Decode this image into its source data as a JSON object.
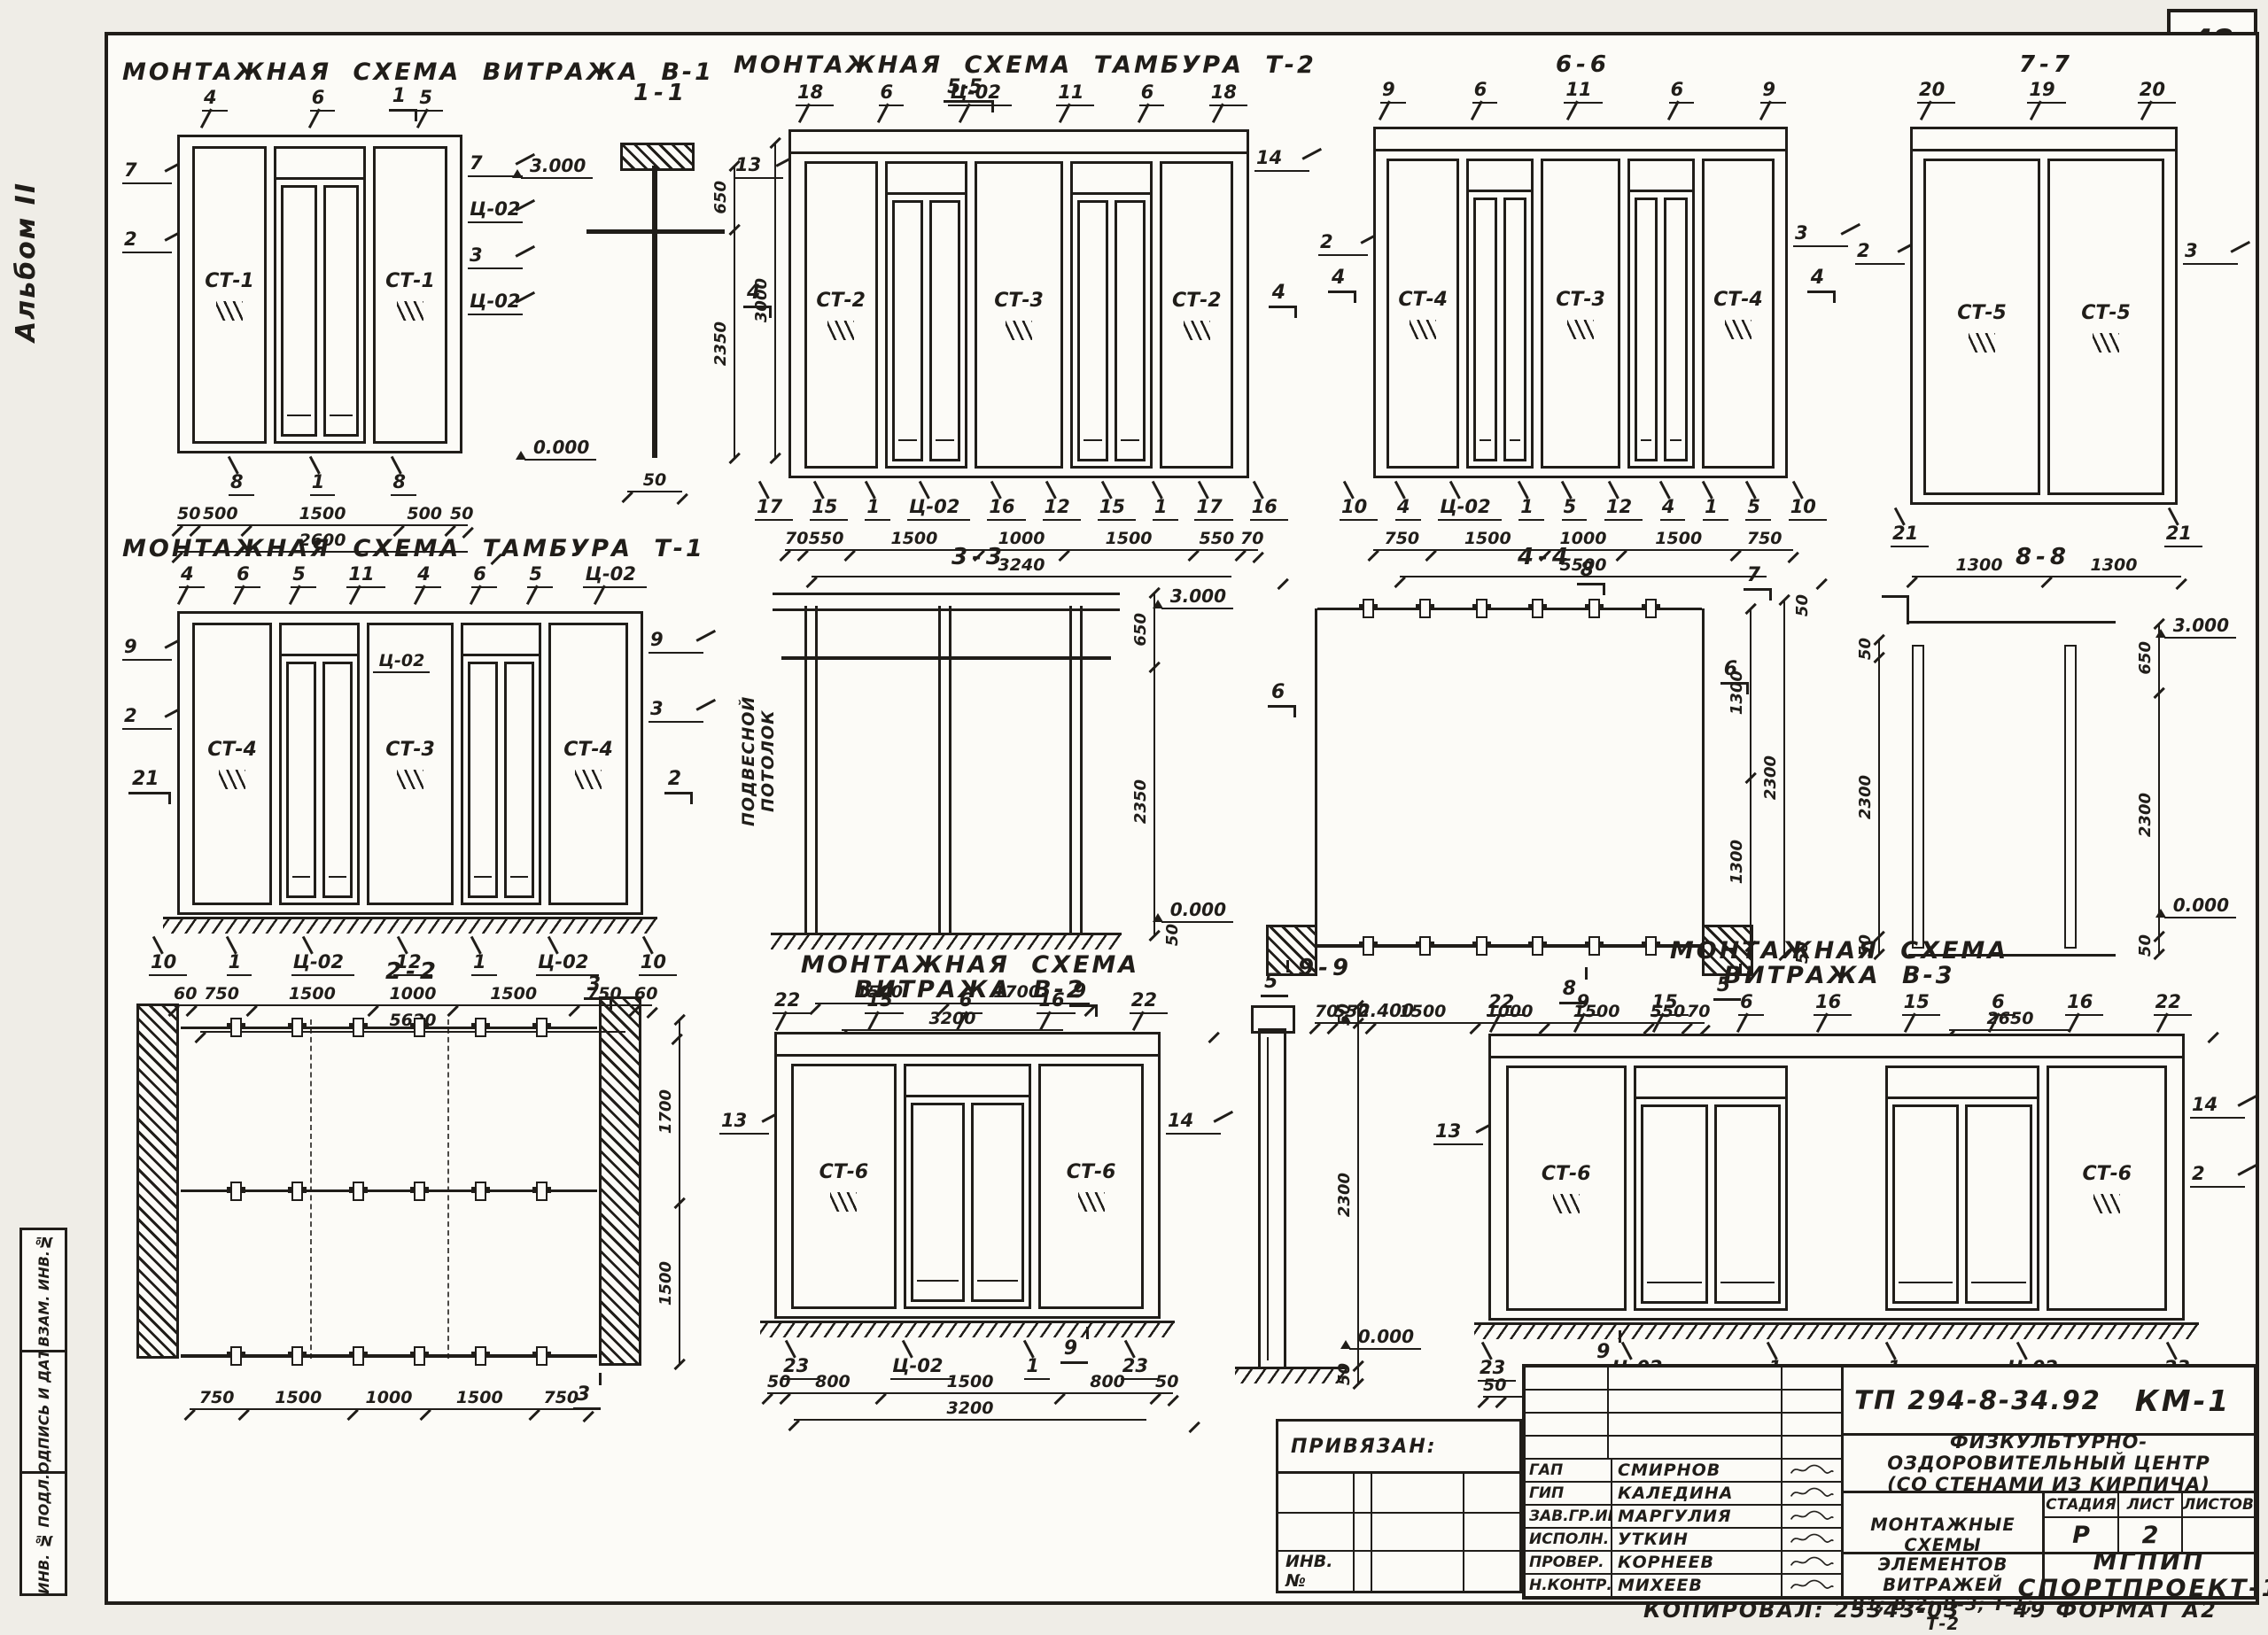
{
  "page": {
    "album_label": "Альбом II",
    "page_number": "48",
    "edge_strip": [
      "ВЗАМ. ИНВ.№",
      "ПОДПИСЬ И ДАТА",
      "ИНВ. № ПОДЛ."
    ]
  },
  "drawings": {
    "v1": {
      "title": "МОНТАЖНАЯ СХЕМА ВИТРАЖА В-1",
      "smark_top": "1",
      "smark_bottom": "1",
      "callouts_top": [
        "4",
        "6",
        "5"
      ],
      "callouts_left": [
        "7",
        "2"
      ],
      "callouts_right": [
        "7",
        "Ц-02",
        "3",
        "Ц-02"
      ],
      "callouts_bottom": [
        "8",
        "1",
        "8"
      ],
      "panels": [
        "СТ-1",
        "СТ-1"
      ],
      "dims": [
        "50",
        "500",
        "1500",
        "500",
        "50"
      ],
      "total": "2600"
    },
    "s11": {
      "title": "1-1",
      "level_top": "3.000",
      "level_bottom": "0.000",
      "dims_right": [
        "650",
        "2350"
      ],
      "dim_total_right": "3000",
      "dim_bottom": "50"
    },
    "t2": {
      "title": "МОНТАЖНАЯ СХЕМА ТАМБУРА Т-2",
      "smark_flag": "5-5",
      "callouts_top": [
        "18",
        "6",
        "Ц-02",
        "11",
        "6",
        "18"
      ],
      "callouts_left": [
        "13"
      ],
      "smark_left": "4",
      "callouts_right": [
        "14"
      ],
      "smark_right": "4",
      "callouts_bottom": [
        "17",
        "15",
        "1",
        "Ц-02",
        "16",
        "12",
        "15",
        "1",
        "17",
        "16"
      ],
      "panels": [
        "СТ-2",
        "СТ-3",
        "СТ-2"
      ],
      "dims": [
        "70",
        "550",
        "1500",
        "1000",
        "1500",
        "550",
        "70"
      ],
      "total": "3240"
    },
    "s66": {
      "title": "6-6",
      "callouts_top": [
        "9",
        "6",
        "11",
        "6",
        "9"
      ],
      "callouts_left": [
        "2"
      ],
      "smark_left": "4",
      "callouts_right": [
        "3"
      ],
      "smark_right": "4",
      "callouts_bottom": [
        "10",
        "4",
        "Ц-02",
        "1",
        "5",
        "12",
        "4",
        "1",
        "5",
        "10"
      ],
      "panels": [
        "СТ-4",
        "СТ-3",
        "СТ-4"
      ],
      "dims": [
        "750",
        "1500",
        "1000",
        "1500",
        "750"
      ],
      "total": "5500"
    },
    "s77": {
      "title": "7-7",
      "callouts_top": [
        "20",
        "19",
        "20"
      ],
      "callouts_left": [
        "2"
      ],
      "callouts_right": [
        "3"
      ],
      "callouts_bottom": [
        "21",
        "21"
      ],
      "panels": [
        "СТ-5",
        "СТ-5"
      ],
      "dims": [
        "1300",
        "1300"
      ]
    },
    "t1": {
      "title": "МОНТАЖНАЯ СХЕМА ТАМБУРА Т-1",
      "callouts_top": [
        "4",
        "6",
        "5",
        "11",
        "4",
        "6",
        "5",
        "Ц-02"
      ],
      "callouts_left": [
        "9",
        "2"
      ],
      "smark_left": "21",
      "callouts_right": [
        "9",
        "3"
      ],
      "smark_right": "2",
      "inner_label": "Ц-02",
      "callouts_bottom": [
        "10",
        "1",
        "Ц-02",
        "12",
        "1",
        "Ц-02",
        "10"
      ],
      "panels": [
        "СТ-4",
        "СТ-3",
        "СТ-4"
      ],
      "dims": [
        "60",
        "750",
        "1500",
        "1000",
        "1500",
        "750",
        "60"
      ],
      "total": "5620"
    },
    "s33": {
      "title": "3-3",
      "note": "ПОДВЕСНОЙ ПОТОЛОК",
      "level_top": "3.000",
      "level_bottom": "0.000",
      "dims_right": [
        "650",
        "2350"
      ],
      "dim_small": "50",
      "dims": [
        "1500",
        "1700"
      ],
      "total": "3200"
    },
    "s44": {
      "title": "4-4",
      "marks": {
        "top": "8",
        "top_right": "7",
        "left": "6",
        "right": "6",
        "bottom_left": "5",
        "bottom_right": "5",
        "bottom": "8"
      },
      "dims": [
        "70",
        "550",
        "1500",
        "1000",
        "1500",
        "550",
        "70"
      ],
      "dims_right": [
        "1300",
        "1300"
      ],
      "dim_far_right": "2300",
      "dim_small_top": "50",
      "dim_small_bottom": "50"
    },
    "s88": {
      "title": "8-8",
      "level_top": "3.000",
      "level_bottom": "0.000",
      "dims_left": [
        "50",
        "2300",
        "50"
      ],
      "dims_right": [
        "650",
        "2300",
        "50"
      ],
      "total": "2650"
    },
    "s22": {
      "title": "2-2",
      "smark_top": "3",
      "smark_bottom": "3",
      "dims": [
        "750",
        "1500",
        "1000",
        "1500",
        "750"
      ],
      "dims_right": [
        "1700",
        "1500"
      ]
    },
    "v2": {
      "title_1": "МОНТАЖНАЯ СХЕМА",
      "title_2": "ВИТРАЖА В-2",
      "smark_top": "9",
      "smark_bottom": "9",
      "callouts_top": [
        "22",
        "15",
        "6",
        "16",
        "22"
      ],
      "callouts_left": [
        "13"
      ],
      "callouts_right": [
        "14"
      ],
      "callouts_bottom": [
        "23",
        "Ц-02",
        "1",
        "23"
      ],
      "panels": [
        "СТ-6",
        "СТ-6"
      ],
      "dims": [
        "50",
        "800",
        "1500",
        "800",
        "50"
      ],
      "total": "3200"
    },
    "s99": {
      "title": "9-9",
      "level_top": "2.400",
      "level_bottom": "0.000",
      "dims_right": [
        "50",
        "2300",
        "50"
      ]
    },
    "v3": {
      "title_1": "МОНТАЖНАЯ СХЕМА",
      "title_2": "ВИТРАЖА В-3",
      "smark_bottom": "9",
      "callouts_top": [
        "22",
        "9",
        "15",
        "6",
        "16",
        "15",
        "6",
        "16",
        "22"
      ],
      "callouts_left": [
        "13"
      ],
      "callouts_right": [
        "14",
        "2"
      ],
      "callouts_bottom": [
        "23",
        "Ц-02",
        "1",
        "1",
        "Ц-02",
        "23"
      ],
      "panels": [
        "СТ-6",
        "СТ-6"
      ],
      "dims": [
        "50",
        "800",
        "1500",
        "50",
        "900",
        "50",
        "1500",
        "800",
        "50"
      ],
      "total": "5700"
    }
  },
  "titleblock": {
    "attached_label": "ПРИВЯЗАН:",
    "inv_label": "ИНВ. №",
    "doc_code": "ТП 294-8-34.92",
    "set_code": "КМ-1",
    "project_line1": "ФИЗКУЛЬТУРНО-ОЗДОРОВИТЕЛЬНЫЙ ЦЕНТР",
    "project_line2": "(СО СТЕНАМИ ИЗ КИРПИЧА)",
    "stage_label": "СТАДИЯ",
    "sheet_label": "ЛИСТ",
    "sheets_label": "ЛИСТОВ",
    "stage": "Р",
    "sheet": "2",
    "sheets": "",
    "content_line1": "МОНТАЖНЫЕ СХЕМЫ",
    "content_line2": "ЭЛЕМЕНТОВ ВИТРАЖЕЙ",
    "content_line3": "В1; В-2; В-3; Т-1; Т-2",
    "org_line1": "МГПИП",
    "org_line2": "СПОРТПРОЕКТ-1",
    "roles": [
      {
        "role": "ГАП",
        "name": "СМИРНОВ"
      },
      {
        "role": "ГИП",
        "name": "КАЛЕДИНА"
      },
      {
        "role": "ЗАВ.ГР.ИН.",
        "name": "МАРГУЛИЯ"
      },
      {
        "role": "ИСПОЛН.",
        "name": "УТКИН"
      },
      {
        "role": "ПРОВЕР.",
        "name": "КОРНЕЕВ"
      },
      {
        "role": "Н.КОНТР.",
        "name": "МИХЕЕВ"
      }
    ],
    "copy_note": "КОПИРОВАЛ: 25343-03",
    "format_note": "49 ФОРМАТ А2"
  }
}
